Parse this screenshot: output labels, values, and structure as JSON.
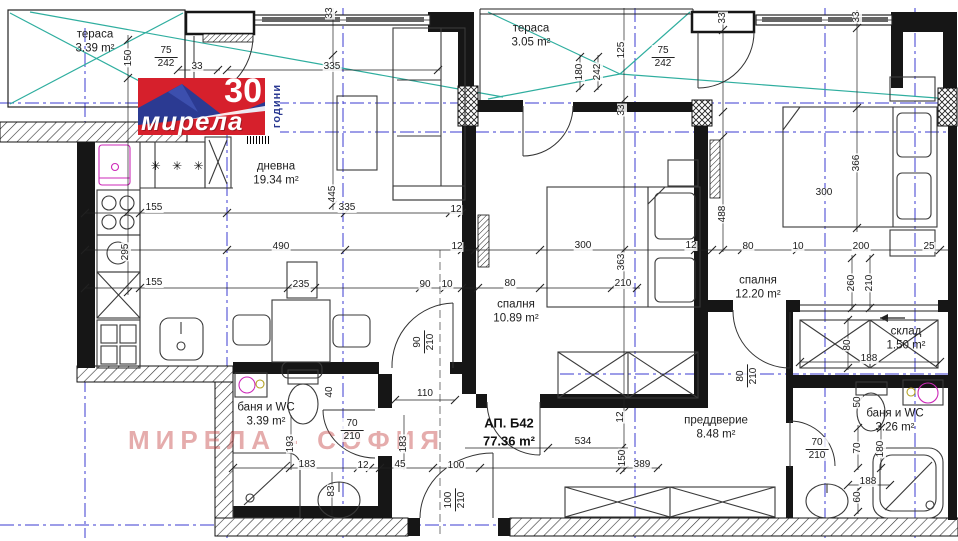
{
  "logo": {
    "brand": "мирела",
    "years": "30",
    "years_word": "години"
  },
  "watermark": "МИРЕЛА - СОФИЯ",
  "apartment": {
    "label": "АП. Б42",
    "area": "77.36 m²"
  },
  "rooms": [
    {
      "name": "тераса",
      "area": "3.39 m²",
      "x": 95,
      "y": 42
    },
    {
      "name": "тераса",
      "area": "3.05 m²",
      "x": 531,
      "y": 36
    },
    {
      "name": "дневна",
      "area": "19.34 m²",
      "x": 276,
      "y": 174
    },
    {
      "name": "спалня",
      "area": "10.89 m²",
      "x": 516,
      "y": 312
    },
    {
      "name": "спалня",
      "area": "12.20 m²",
      "x": 758,
      "y": 288
    },
    {
      "name": "склад",
      "area": "1.50 m²",
      "x": 906,
      "y": 339
    },
    {
      "name": "баня и WC",
      "area": "3.39 m²",
      "x": 266,
      "y": 415
    },
    {
      "name": "преддверие",
      "area": "8.48 m²",
      "x": 716,
      "y": 428
    },
    {
      "name": "баня и WC",
      "area": "3.26 m²",
      "x": 895,
      "y": 421
    }
  ],
  "dimensions": [
    {
      "t": "150",
      "x": 129,
      "y": 58,
      "r": 1
    },
    {
      "t": "33",
      "x": 197,
      "y": 67,
      "r": 0
    },
    {
      "t": "335",
      "x": 332,
      "y": 67,
      "r": 0
    },
    {
      "t": "33",
      "x": 330,
      "y": 13,
      "r": 1
    },
    {
      "t": "125",
      "x": 622,
      "y": 50,
      "r": 1
    },
    {
      "t": "180",
      "x": 580,
      "y": 72,
      "r": 1
    },
    {
      "t": "242",
      "x": 598,
      "y": 72,
      "r": 1
    },
    {
      "t": "33",
      "x": 622,
      "y": 110,
      "r": 1
    },
    {
      "t": "33",
      "x": 723,
      "y": 18,
      "r": 1
    },
    {
      "t": "33",
      "x": 857,
      "y": 17,
      "r": 1
    },
    {
      "t": "366",
      "x": 857,
      "y": 163,
      "r": 1
    },
    {
      "t": "300",
      "x": 824,
      "y": 193,
      "r": 0
    },
    {
      "t": "155",
      "x": 154,
      "y": 208,
      "r": 0
    },
    {
      "t": "335",
      "x": 347,
      "y": 208,
      "r": 0
    },
    {
      "t": "12",
      "x": 456,
      "y": 210,
      "r": 0
    },
    {
      "t": "445",
      "x": 333,
      "y": 194,
      "r": 1
    },
    {
      "t": "490",
      "x": 281,
      "y": 247,
      "r": 0
    },
    {
      "t": "12",
      "x": 457,
      "y": 247,
      "r": 0
    },
    {
      "t": "300",
      "x": 583,
      "y": 246,
      "r": 0
    },
    {
      "t": "12",
      "x": 691,
      "y": 246,
      "r": 0
    },
    {
      "t": "488",
      "x": 723,
      "y": 214,
      "r": 1
    },
    {
      "t": "80",
      "x": 748,
      "y": 247,
      "r": 0
    },
    {
      "t": "10",
      "x": 798,
      "y": 247,
      "r": 0
    },
    {
      "t": "200",
      "x": 861,
      "y": 247,
      "r": 0
    },
    {
      "t": "25",
      "x": 929,
      "y": 247,
      "r": 0
    },
    {
      "t": "155",
      "x": 154,
      "y": 283,
      "r": 0
    },
    {
      "t": "235",
      "x": 301,
      "y": 285,
      "r": 0
    },
    {
      "t": "90",
      "x": 425,
      "y": 285,
      "r": 0
    },
    {
      "t": "10",
      "x": 447,
      "y": 285,
      "r": 0
    },
    {
      "t": "80",
      "x": 510,
      "y": 284,
      "r": 0
    },
    {
      "t": "363",
      "x": 622,
      "y": 262,
      "r": 1
    },
    {
      "t": "210",
      "x": 623,
      "y": 284,
      "r": 0
    },
    {
      "t": "295",
      "x": 126,
      "y": 252,
      "r": 1
    },
    {
      "t": "260",
      "x": 852,
      "y": 283,
      "r": 1
    },
    {
      "t": "210",
      "x": 870,
      "y": 283,
      "r": 1
    },
    {
      "t": "80",
      "x": 848,
      "y": 345,
      "r": 1
    },
    {
      "t": "188",
      "x": 869,
      "y": 359,
      "r": 0
    },
    {
      "t": "40",
      "x": 330,
      "y": 392,
      "r": 1
    },
    {
      "t": "110",
      "x": 425,
      "y": 394,
      "r": 0
    },
    {
      "t": "12",
      "x": 621,
      "y": 417,
      "r": 1
    },
    {
      "t": "534",
      "x": 583,
      "y": 442,
      "r": 0
    },
    {
      "t": "193",
      "x": 291,
      "y": 444,
      "r": 1
    },
    {
      "t": "183",
      "x": 404,
      "y": 444,
      "r": 1
    },
    {
      "t": "150",
      "x": 623,
      "y": 458,
      "r": 1
    },
    {
      "t": "183",
      "x": 307,
      "y": 465,
      "r": 0
    },
    {
      "t": "12",
      "x": 363,
      "y": 466,
      "r": 0
    },
    {
      "t": "45",
      "x": 400,
      "y": 465,
      "r": 0
    },
    {
      "t": "100",
      "x": 456,
      "y": 466,
      "r": 0
    },
    {
      "t": "389",
      "x": 642,
      "y": 465,
      "r": 0
    },
    {
      "t": "83",
      "x": 332,
      "y": 491,
      "r": 1
    },
    {
      "t": "50",
      "x": 858,
      "y": 402,
      "r": 1
    },
    {
      "t": "70",
      "x": 858,
      "y": 448,
      "r": 1
    },
    {
      "t": "180",
      "x": 881,
      "y": 449,
      "r": 1
    },
    {
      "t": "188",
      "x": 868,
      "y": 482,
      "r": 0
    },
    {
      "t": "60",
      "x": 858,
      "y": 497,
      "r": 1
    }
  ],
  "door_sizes": [
    {
      "top": "75",
      "bot": "242",
      "x": 166,
      "y": 57,
      "r": 0
    },
    {
      "top": "75",
      "bot": "242",
      "x": 663,
      "y": 57,
      "r": 0
    },
    {
      "top": "70",
      "bot": "210",
      "x": 352,
      "y": 430,
      "r": 0
    },
    {
      "top": "70",
      "bot": "210",
      "x": 817,
      "y": 449,
      "r": 0
    },
    {
      "top": "90",
      "bot": "210",
      "x": 424,
      "y": 342,
      "r": 1
    },
    {
      "top": "100",
      "bot": "210",
      "x": 455,
      "y": 500,
      "r": 1
    },
    {
      "top": "80",
      "bot": "210",
      "x": 747,
      "y": 376,
      "r": 1
    }
  ],
  "symbols": [
    {
      "t": "✳ ✳ ✳",
      "x": 179,
      "y": 166
    }
  ],
  "colors": {
    "wall": "#161616",
    "axis_blue": "#3b3bd1",
    "glazing_teal": "#2fae9f",
    "fixture_magenta": "#cc29b8",
    "logo_red": "#d6202c",
    "logo_blue": "#2b3a92",
    "watermark": "rgba(198,70,70,0.45)"
  }
}
